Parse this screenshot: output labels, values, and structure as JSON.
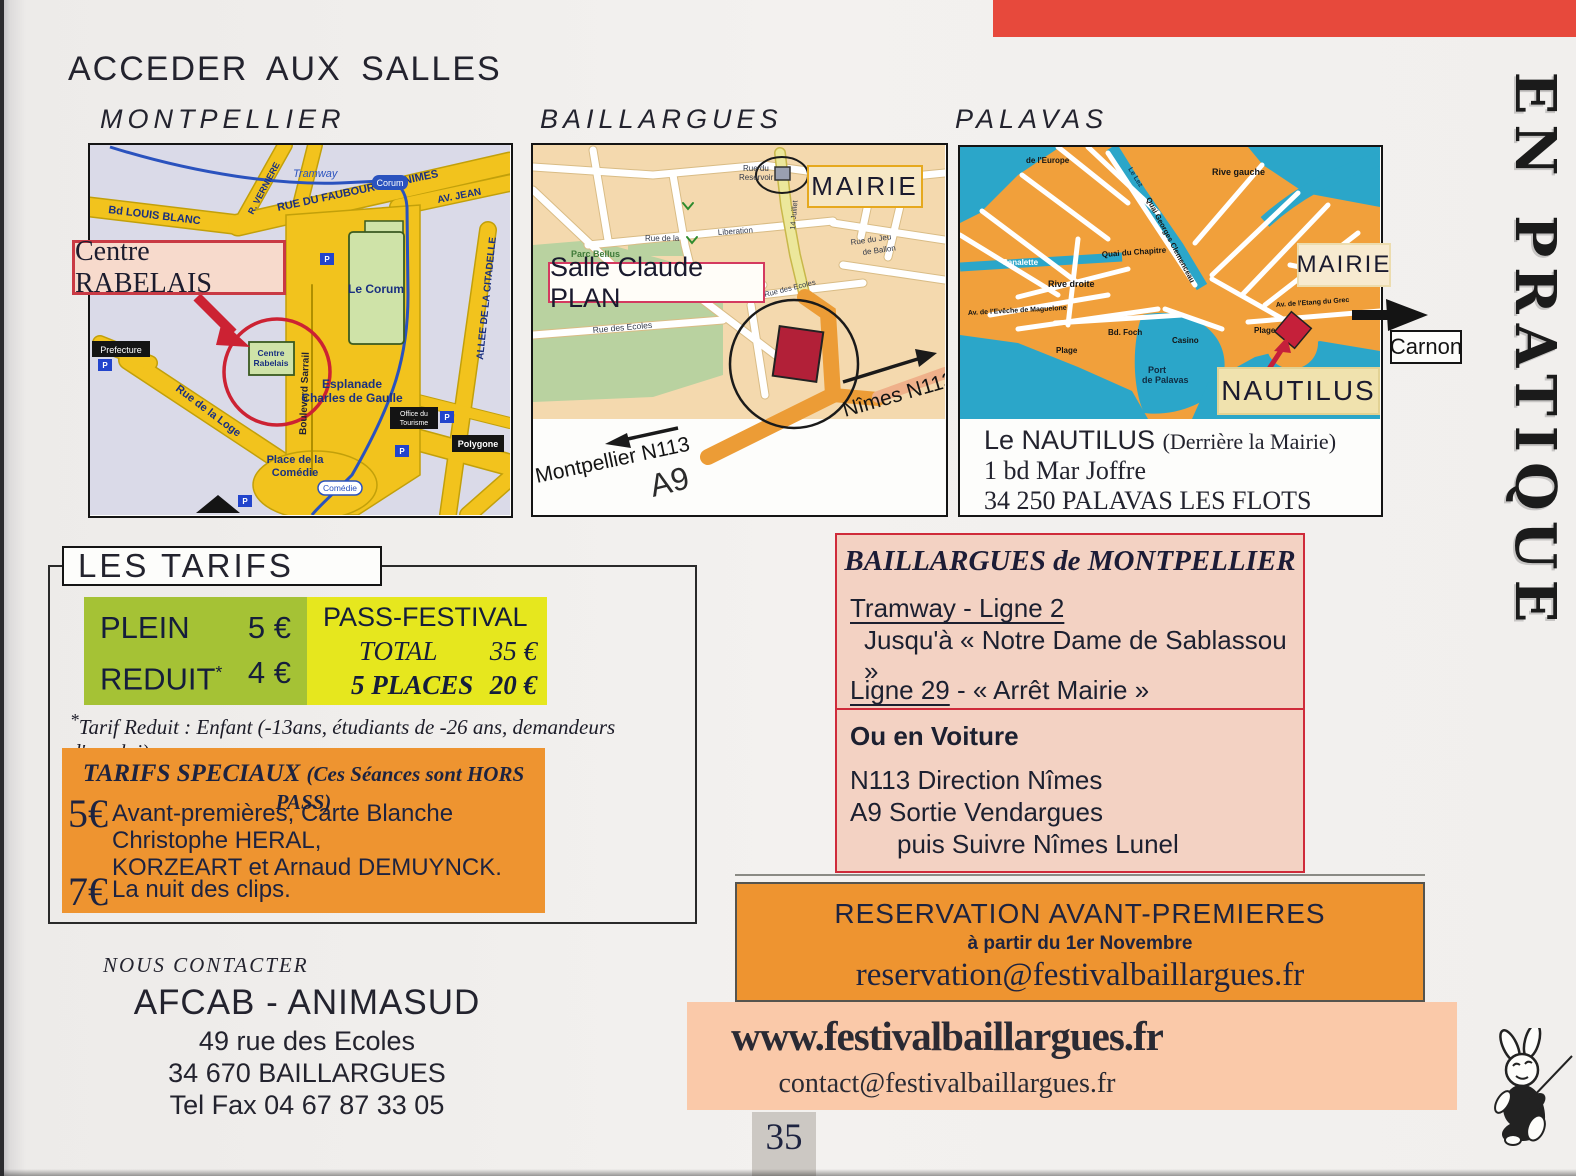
{
  "page": {
    "title": "ACCEDER AUX SALLES",
    "side_title": "EN PRATIQUE",
    "page_number": "35"
  },
  "icons": {
    "mascot": "rabbit-guitar-mascot",
    "parking": "P"
  },
  "colors": {
    "accent_red": "#e7493c",
    "orange": "#ee9430",
    "green": "#a5c235",
    "yellow": "#e6e71e",
    "salmon": "#f3d2c3",
    "site_pink": "#fac9a9",
    "map_orange": "#f1a03b",
    "map_water": "#2ba6c9"
  },
  "maps": {
    "montpellier": {
      "label": "MONTPELLIER",
      "callout": "Centre RABELAIS",
      "parking": "P",
      "streets": {
        "louis_blanc": "Bd LOUIS BLANC",
        "verniere": "R. VERNIERE",
        "faubourg": "RUE DU FAUBOURG DE NIMES",
        "av_jean": "AV. JEAN",
        "tramway": "Tramway",
        "corum_stop": "Corum",
        "le_corum": "Le Corum",
        "citadelle": "ALLEE DE LA CITADELLE",
        "sarrail": "Boulevard Sarrail",
        "rabelais_1": "Centre",
        "rabelais_2": "Rabelais",
        "esplanade_1": "Esplanade",
        "esplanade_2": "Charles de Gaulle",
        "prefecture": "Prefecture",
        "loge": "Rue de la Loge",
        "comedie_1": "Place de la",
        "comedie_2": "Comédie",
        "comedie_stop": "Comédie",
        "office_1": "Office du",
        "office_2": "Tourisme",
        "polygone": "Polygone"
      }
    },
    "baillargues": {
      "label": "BAILLARGUES",
      "callout_mairie": "MAIRIE",
      "callout_salle": "Salle Claude PLAN",
      "streets": {
        "reservoir_1": "Rue du",
        "reservoir_2": "Reservoir",
        "rue_de_la": "Rue de la",
        "liberation": "Liberation",
        "quatorze": "14 Juillet",
        "jeu_1": "Rue du Jeu",
        "jeu_2": "de Ballon",
        "ecoles": "Rue des Ecoles",
        "ecoles2": "Rue des Ecoles",
        "parc": "Parc Bellus"
      },
      "directions": {
        "nimes": "Nîmes N113",
        "montpellier": "Montpellier N113",
        "a9": "A9"
      }
    },
    "palavas": {
      "label": "PALAVAS",
      "callout_mairie": "MAIRIE",
      "callout_nautilus": "NAUTILUS",
      "callout_carnon": "Carnon",
      "streets": {
        "europe": "de l'Europe",
        "rive_gauche": "Rive gauche",
        "le_lez": "Le Lez",
        "canalette": "Canalette",
        "chapitre": "Quai du Chapitre",
        "clemenceau": "Quai Georges Clemenceau",
        "rive_droite": "Rive droite",
        "eveche": "Av. de l'Evêche de Maguelone",
        "foch": "Bd. Foch",
        "casino": "Casino",
        "plage": "Plage",
        "port_1": "Port",
        "port_2": "de Palavas",
        "etang": "Av. de l'Etang du Grec"
      },
      "address": {
        "name": "Le NAUTILUS",
        "note": "(Derrière la Mairie)",
        "line2": "1 bd Mar Joffre",
        "line3": "34 250 PALAVAS LES FLOTS"
      }
    }
  },
  "tarifs": {
    "title": "LES TARIFS",
    "plein_label": "PLEIN",
    "plein_price": "5 €",
    "reduit_label": "REDUIT",
    "reduit_star": "*",
    "reduit_price": "4 €",
    "pass_title": "PASS-FESTIVAL",
    "total_label": "TOTAL",
    "total_price": "35 €",
    "places_label": "5 PLACES",
    "places_price": "20 €",
    "note_star": "*",
    "note": "Tarif Reduit : Enfant (-13ans, étudiants de -26 ans, demandeurs d'emploi)",
    "speciaux": {
      "title": "TARIFS SPECIAUX ",
      "title_suffix": "(Ces Séances sont HORS PASS)",
      "item1_price": "5€",
      "item1_line1": "Avant-premières, Carte Blanche Christophe HERAL,",
      "item1_line2": "KORZEART et Arnaud DEMUYNCK.",
      "item2_price": "7€",
      "item2_text": "La nuit des clips."
    }
  },
  "acces": {
    "title": "BAILLARGUES de MONTPELLIER",
    "tram_line": "Tramway - Ligne 2",
    "tram_stop": "Jusqu'à « Notre Dame de Sablassou »",
    "bus_line": "Ligne 29",
    "bus_stop": " - « Arrêt Mairie »",
    "car_title": "Ou en Voiture",
    "car_line1": "N113 Direction Nîmes",
    "car_line2": "A9 Sortie Vendargues",
    "car_line3": "puis Suivre Nîmes Lunel"
  },
  "reservation": {
    "title": "RESERVATION AVANT-PREMIERES",
    "subtitle": "à partir du 1er Novembre",
    "email": "reservation@festivalbaillargues.fr"
  },
  "website": {
    "url": "www.festivalbaillargues.fr",
    "email": "contact@festivalbaillargues.fr"
  },
  "contact": {
    "title": "NOUS CONTACTER",
    "org": "AFCAB - ANIMASUD",
    "address1": "49 rue des Ecoles",
    "address2": "34 670 BAILLARGUES",
    "phone": "Tel Fax 04 67 87 33 05"
  }
}
